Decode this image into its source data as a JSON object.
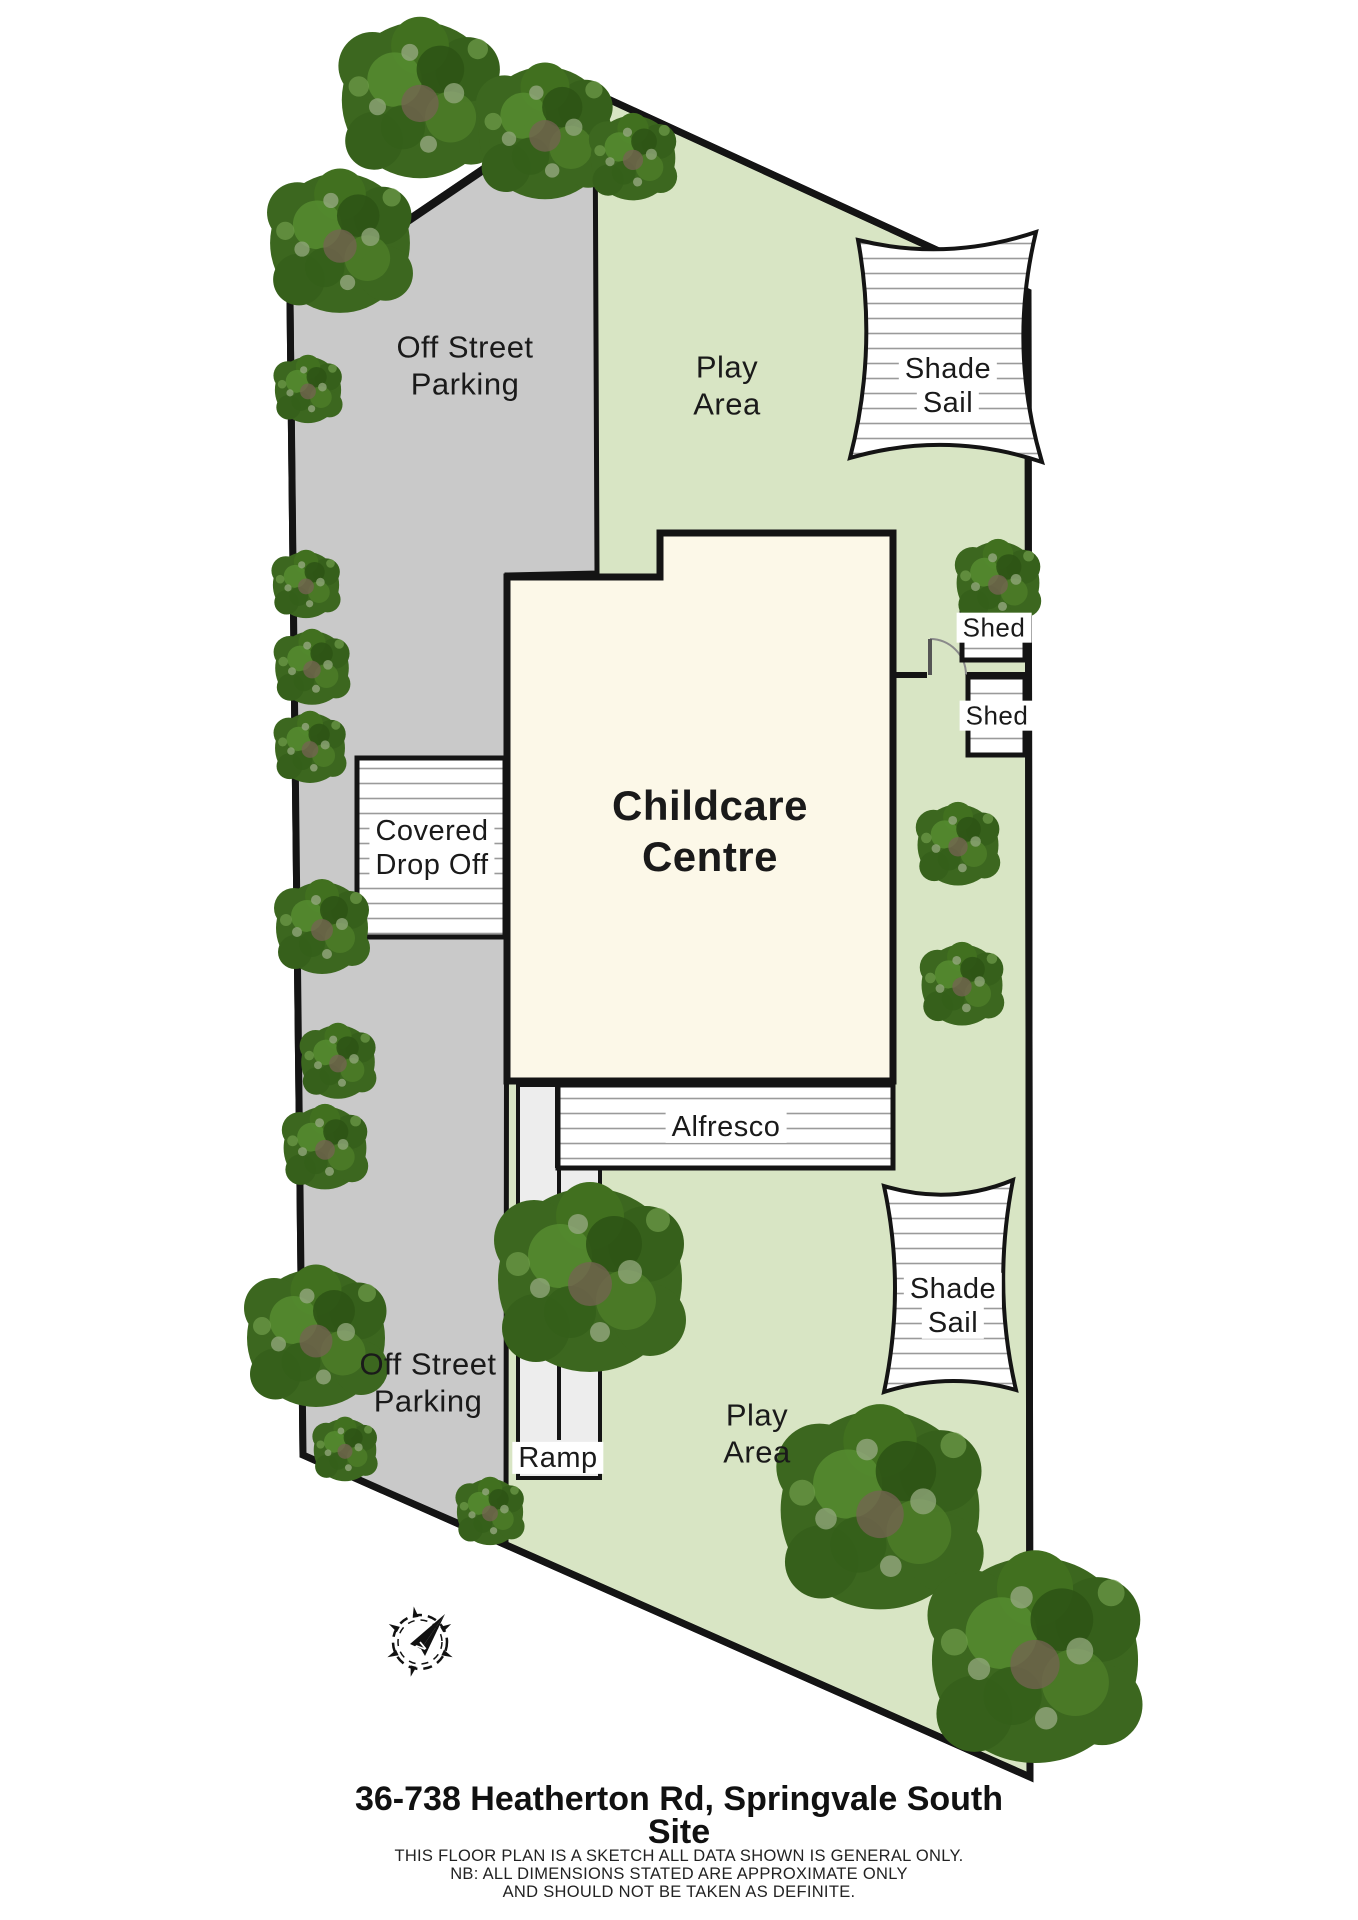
{
  "plan": {
    "labels": {
      "parking_top": {
        "line1": "Off Street",
        "line2": "Parking"
      },
      "parking_bottom": {
        "line1": "Off Street",
        "line2": "Parking"
      },
      "play_top": {
        "line1": "Play",
        "line2": "Area"
      },
      "play_bottom": {
        "line1": "Play",
        "line2": "Area"
      },
      "shade_sail_top": {
        "line1": "Shade",
        "line2": "Sail"
      },
      "shade_sail_bottom": {
        "line1": "Shade",
        "line2": "Sail"
      },
      "shed_top": "Shed",
      "shed_bottom": "Shed",
      "drop_off": {
        "line1": "Covered",
        "line2": "Drop Off"
      },
      "building": {
        "line1": "Childcare",
        "line2": "Centre"
      },
      "alfresco": "Alfresco",
      "ramp": "Ramp",
      "compass_north": "N"
    },
    "footer": {
      "title_line1": "36-738 Heatherton Rd, Springvale South",
      "title_line2": "Site",
      "disclaimer_line1": "THIS FLOOR PLAN IS A SKETCH ALL DATA SHOWN IS GENERAL ONLY.",
      "disclaimer_line2": "NB: ALL DIMENSIONS STATED ARE APPROXIMATE ONLY",
      "disclaimer_line3": "AND SHOULD NOT BE TAKEN AS DEFINITE."
    },
    "colors": {
      "site_green": "#d8e5c4",
      "parking_gray": "#c9c9c9",
      "building_cream": "#fcf8e8",
      "ramp_gray": "#ededed",
      "outline": "#141414",
      "stripe_gray": "#9a9a9a"
    }
  }
}
